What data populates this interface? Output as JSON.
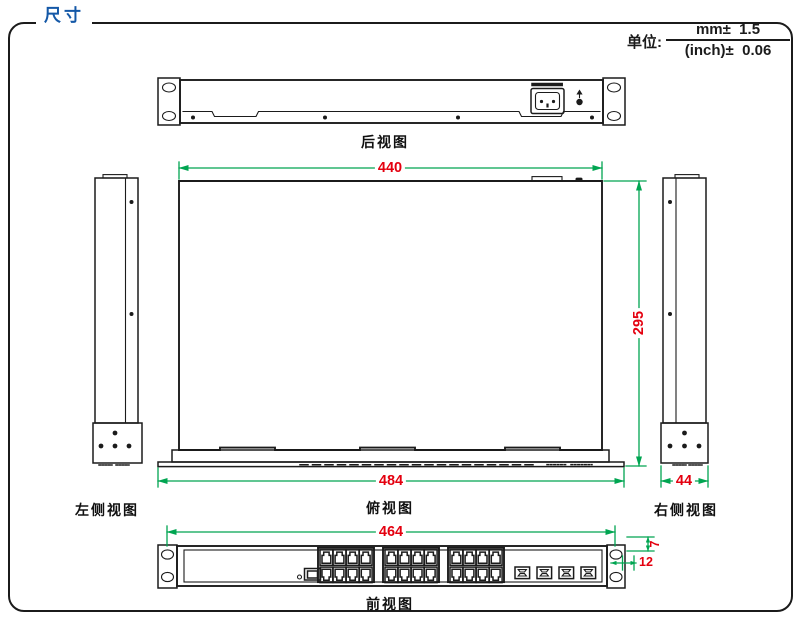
{
  "header": {
    "title": "尺寸",
    "unit_label": "单位:",
    "unit_mm": "mm±  1.5",
    "unit_inch": "(inch)±  0.06"
  },
  "views": {
    "rear_label": "后视图",
    "top_label": "俯视图",
    "left_label": "左侧视图",
    "right_label": "右侧视图",
    "front_label": "前视图"
  },
  "dimensions": {
    "body_width": "440",
    "body_depth": "295",
    "overall_width": "484",
    "side_width": "44",
    "front_mount_width": "464",
    "flange_offset_vertical": "7",
    "flange_offset_horizontal": "12"
  },
  "device": {
    "rj45_port_groups": 3,
    "rj45_ports_per_group": 8,
    "sfp_ports": 4,
    "views_shown": [
      "rear",
      "top",
      "left-side",
      "right-side",
      "front"
    ]
  },
  "colors": {
    "dimension_line": "#00A551",
    "dimension_text": "#E4000F",
    "outline": "#1B1B1B",
    "title_blue": "#1458A7"
  }
}
